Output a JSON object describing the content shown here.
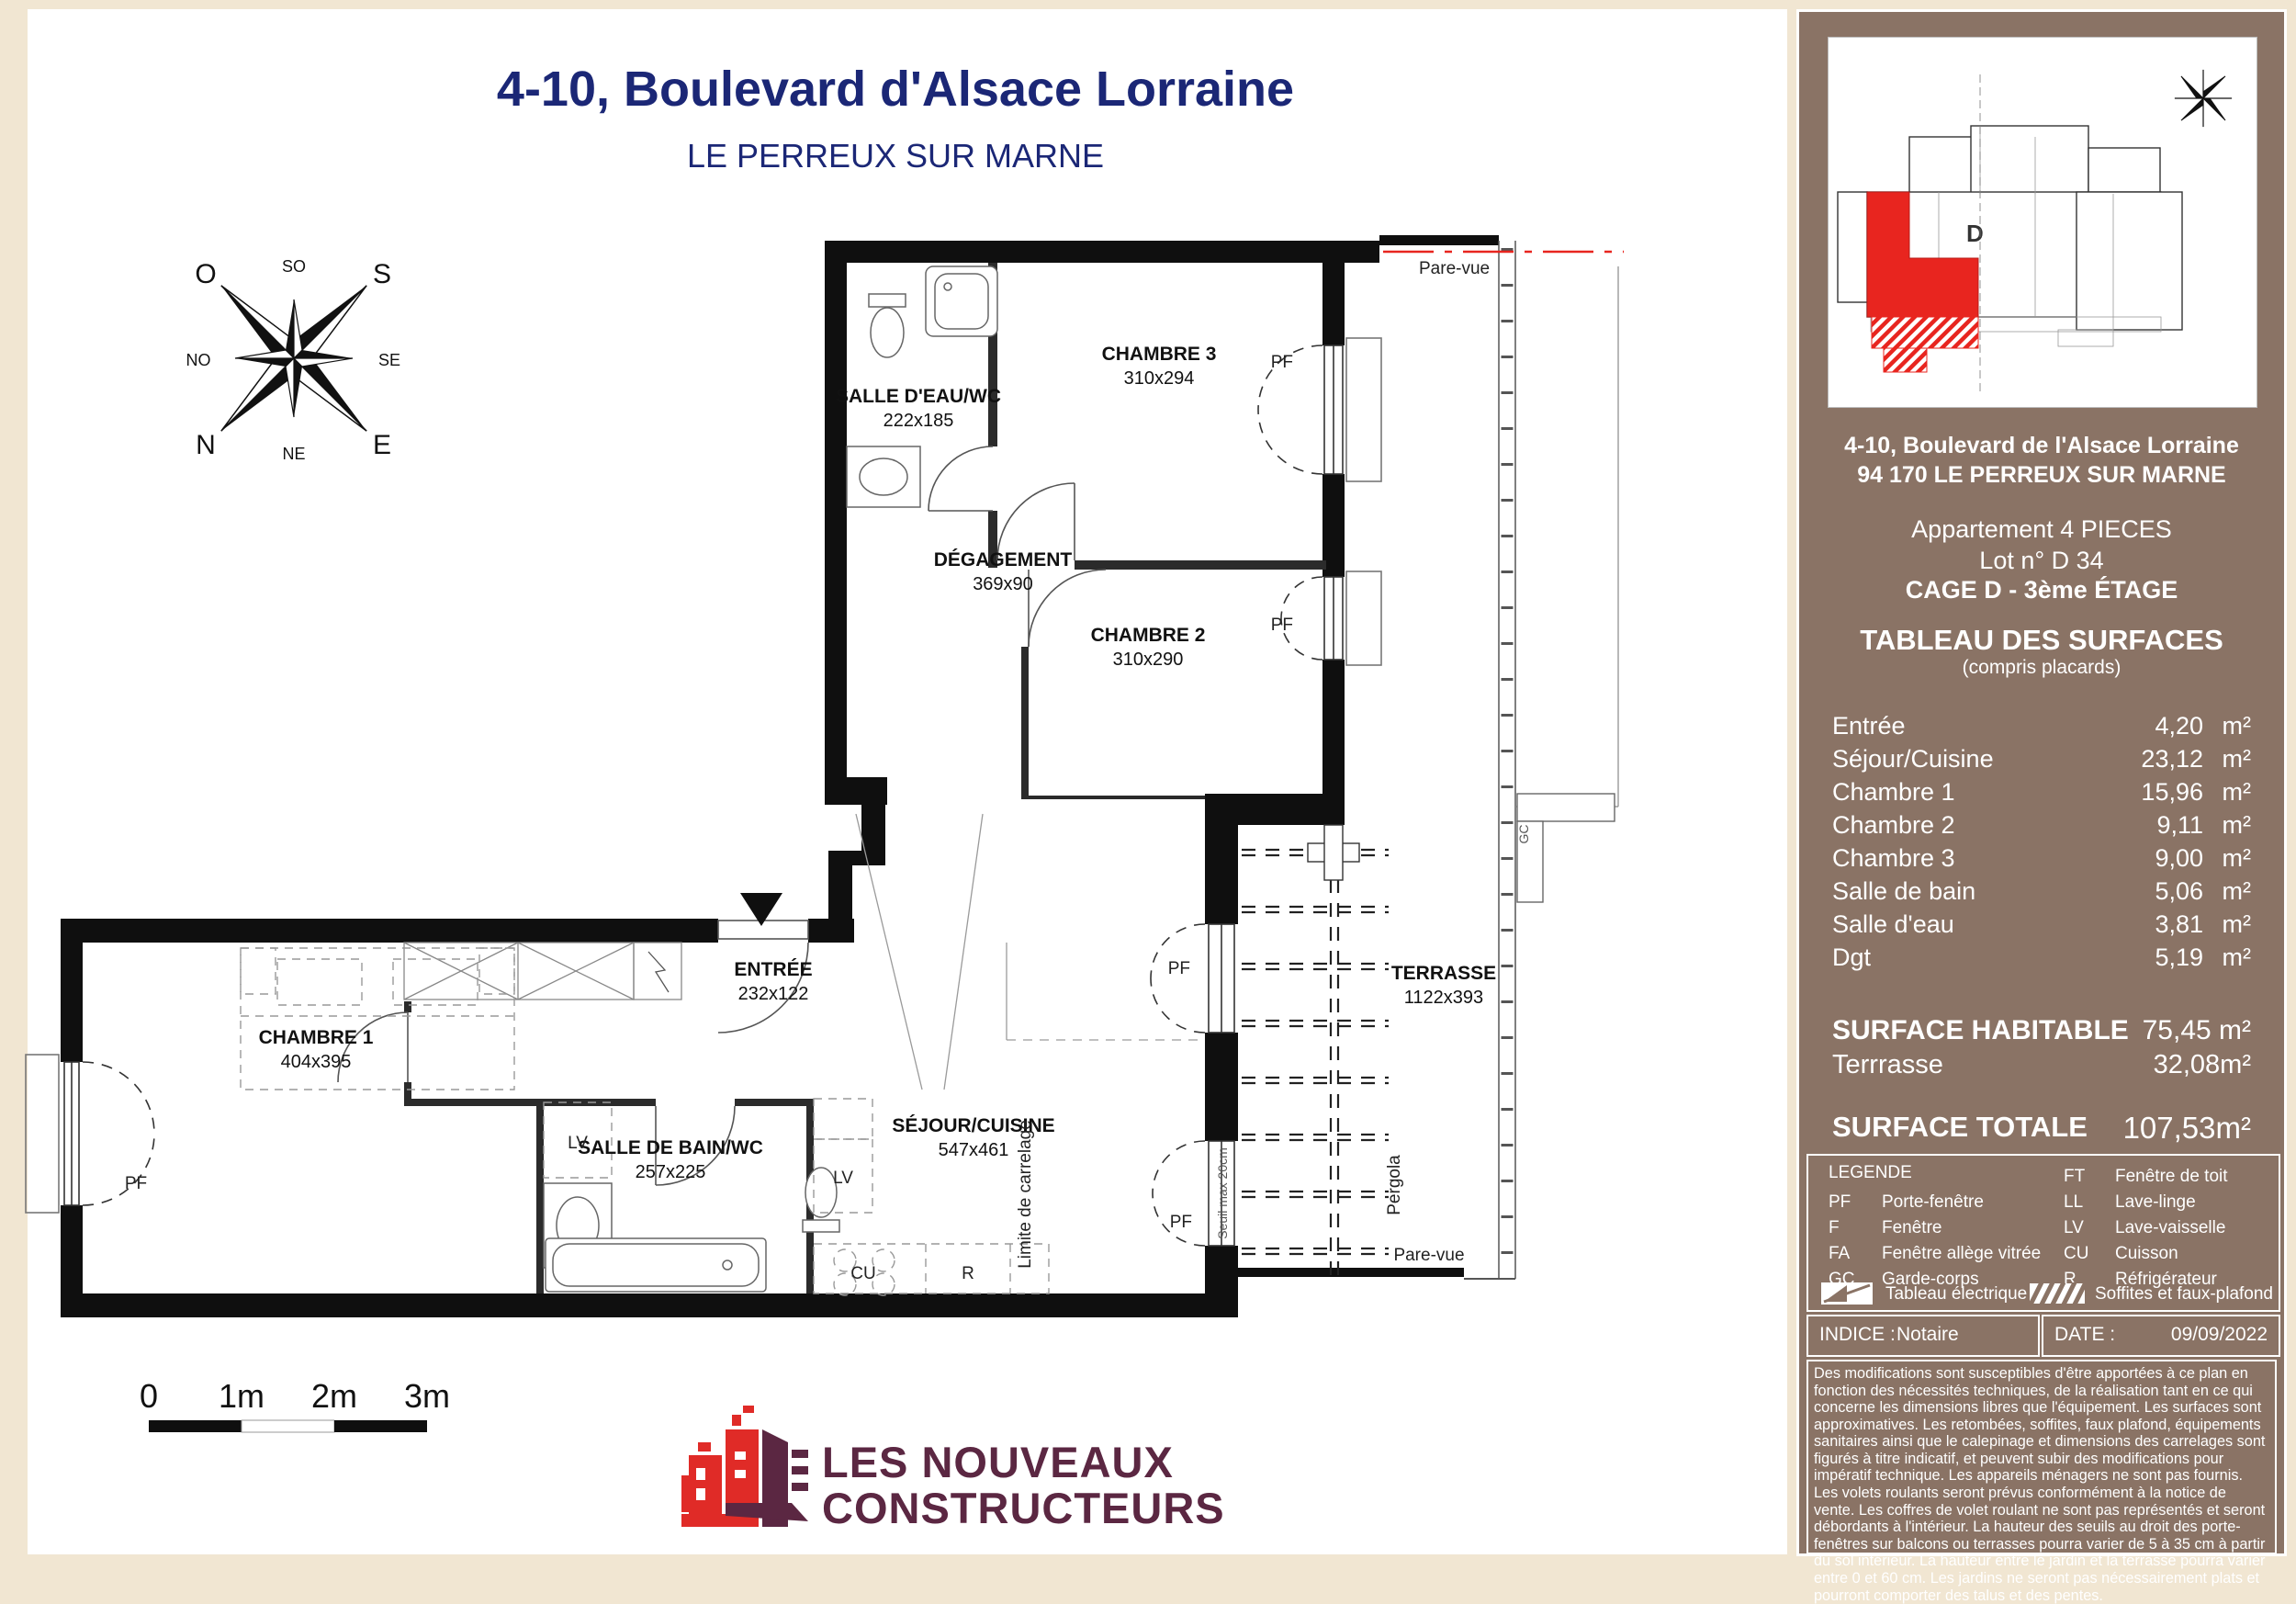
{
  "header": {
    "title": "4-10, Boulevard d'Alsace Lorraine",
    "subtitle": "LE PERREUX SUR MARNE"
  },
  "compass": {
    "n": "N",
    "s": "S",
    "e": "E",
    "o": "O",
    "ne": "NE",
    "no": "NO",
    "se": "SE",
    "so": "SO"
  },
  "plan": {
    "rooms": [
      {
        "name": "SALLE D'EAU/WC",
        "dims": "222x185"
      },
      {
        "name": "CHAMBRE 3",
        "dims": "310x294"
      },
      {
        "name": "DÉGAGEMENT",
        "dims": "369x90"
      },
      {
        "name": "CHAMBRE 2",
        "dims": "310x290"
      },
      {
        "name": "CHAMBRE 1",
        "dims": "404x395"
      },
      {
        "name": "ENTRÉE",
        "dims": "232x122"
      },
      {
        "name": "SALLE DE BAIN/WC",
        "dims": "257x225"
      },
      {
        "name": "SÉJOUR/CUISINE",
        "dims": "547x461"
      },
      {
        "name": "TERRASSE",
        "dims": "1122x393"
      }
    ],
    "annotations": {
      "pare_vue_top": "Pare-vue",
      "pare_vue_bottom": "Pare-vue",
      "pergola": "Pergola",
      "seuil": "Seuil max 20cm",
      "limite_carrelage": "Limite de carrelage",
      "gc": "GC",
      "pf": "PF",
      "lv": "LV",
      "cu": "CU",
      "r": "R"
    },
    "scale_bar": {
      "labels": [
        "0",
        "1m",
        "2m",
        "3m"
      ]
    }
  },
  "sidebar": {
    "keyplan_d": "D",
    "address_line1": "4-10, Boulevard de l'Alsace Lorraine",
    "address_line2": "94 170 LE PERREUX SUR MARNE",
    "apartment_type": "Appartement 4 PIECES",
    "lot": "Lot n° D 34",
    "cage": "CAGE D - 3ème ÉTAGE",
    "table_title": "TABLEAU DES SURFACES",
    "table_subtitle": "(compris placards)",
    "rows": [
      {
        "label": "Entrée",
        "value": "4,20",
        "unit": "m²"
      },
      {
        "label": "Séjour/Cuisine",
        "value": "23,12",
        "unit": "m²"
      },
      {
        "label": "Chambre 1",
        "value": "15,96",
        "unit": "m²"
      },
      {
        "label": "Chambre 2",
        "value": "9,11",
        "unit": "m²"
      },
      {
        "label": "Chambre 3",
        "value": "9,00",
        "unit": "m²"
      },
      {
        "label": "Salle de bain",
        "value": "5,06",
        "unit": "m²"
      },
      {
        "label": "Salle d'eau",
        "value": "3,81",
        "unit": "m²"
      },
      {
        "label": "Dgt",
        "value": "5,19",
        "unit": "m²"
      }
    ],
    "hab_label": "SURFACE HABITABLE",
    "hab_value": "75,45 m²",
    "terrasse_label": "Terrrasse",
    "terrasse_value": "32,08m²",
    "total_label": "SURFACE TOTALE",
    "total_value": "107,53m²",
    "legend": {
      "title": "LEGENDE",
      "left": [
        {
          "abbr": "PF",
          "label": "Porte-fenêtre"
        },
        {
          "abbr": "F",
          "label": "Fenêtre"
        },
        {
          "abbr": "FA",
          "label": "Fenêtre allège vitrée"
        },
        {
          "abbr": "GC",
          "label": "Garde-corps"
        }
      ],
      "right": [
        {
          "abbr": "FT",
          "label": "Fenêtre de toit"
        },
        {
          "abbr": "LL",
          "label": "Lave-linge"
        },
        {
          "abbr": "LV",
          "label": "Lave-vaisselle"
        },
        {
          "abbr": "CU",
          "label": "Cuisson"
        },
        {
          "abbr": "R",
          "label": "Réfrigérateur"
        }
      ],
      "electric_label": "Tableau électrique",
      "soffites_label": "Soffites et faux-plafond"
    },
    "indice_label": "INDICE :",
    "indice_value": "Notaire",
    "date_label": "DATE :",
    "date_value": "09/09/2022",
    "disclaimer": "Des modifications sont susceptibles d'être apportées à ce plan en fonction des nécessités techniques, de la réalisation tant en ce qui concerne les dimensions libres que l'équipement. Les surfaces sont approximatives. Les retombées, soffites, faux plafond, équipements sanitaires ainsi que le calepinage et dimensions des carrelages sont figurés à titre indicatif, et peuvent subir des modifications pour impératif technique. Les appareils ménagers ne sont pas fournis.  Les volets roulants seront prévus conformément à la notice de vente. Les coffres de volet roulant ne sont pas représentés et seront débordants à l'intérieur. La hauteur des seuils au droit des porte-fenêtres sur balcons ou terrasses pourra varier de 5 à 35 cm à partir du sol intérieur. La hauteur entre le jardin et la terrasse pourra varier entre 0 et 60 cm. Les jardins ne seront pas nécessairement plats et pourront comporter des talus et des pentes."
  },
  "logo": {
    "line1": "LES NOUVEAUX",
    "line2": "CONSTRUCTEURS"
  },
  "colors": {
    "navy": "#1b2776",
    "accent_red": "#e8251f",
    "sidebar_brown": "#8a7365",
    "beige": "#f1e6d2",
    "logo_maroon": "#5b2742",
    "logo_red": "#e02b27"
  }
}
